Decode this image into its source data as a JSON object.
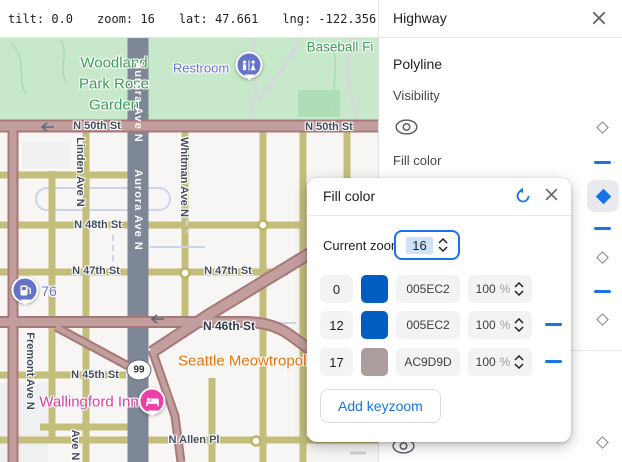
{
  "topbar": {
    "tilt": "tilt: 0.0",
    "zoom": "zoom: 16",
    "lat": "lat: 47.661",
    "lng": "lng: -122.356"
  },
  "panel": {
    "title": "Highway",
    "section_label": "Polyline",
    "visibility_label": "Visibility",
    "fill_color_label": "Fill color"
  },
  "popup": {
    "title": "Fill color",
    "current_zoom_label": "Current zoom",
    "current_zoom_value": "16",
    "percent_sign": "%",
    "add_button_label": "Add keyzoom",
    "rows": [
      {
        "zoom": "0",
        "hex": "005EC2",
        "opacity": "100",
        "swatch_style": "background:#005EC2"
      },
      {
        "zoom": "12",
        "hex": "005EC2",
        "opacity": "100",
        "swatch_style": "background:#005EC2"
      },
      {
        "zoom": "17",
        "hex": "AC9D9D",
        "opacity": "100",
        "swatch_style": "background:#AC9D9D"
      }
    ]
  },
  "map": {
    "streets": {
      "n50th_a": "N 50th St",
      "n50th_b": "N 50th St",
      "n48th": "N 48th St",
      "n47th_a": "N 47th St",
      "n47th_b": "N 47th St",
      "n46th": "N 46th St",
      "n45th": "N 45th St",
      "n_allen": "N Allen Pl",
      "aurora_a": "Aurora Ave N",
      "aurora_b": "Aurora Ave N",
      "linden": "Linden Ave N",
      "whitman": "Whitman Ave N",
      "fremont": "Fremont Ave N",
      "ave_n": "Ave N"
    },
    "park_labels": {
      "woodland": "Woodland Park Rose Garden",
      "baseball": "Baseball Fi"
    },
    "pois": {
      "restroom": "Restroom",
      "gas_station": "76",
      "cat_cafe": "Seattle Meowtropoli",
      "hotel": "Wallingford Inn"
    },
    "highway_shield": "99",
    "colors": {
      "highway_fill_z17": "#AC9D9D",
      "highway_fill_z12": "#005EC2",
      "park_green": "#c7e8ca",
      "aurora_road": "#7e8795",
      "minor_road": "#c4be7b",
      "accent_blue": "#1a73e8"
    }
  }
}
